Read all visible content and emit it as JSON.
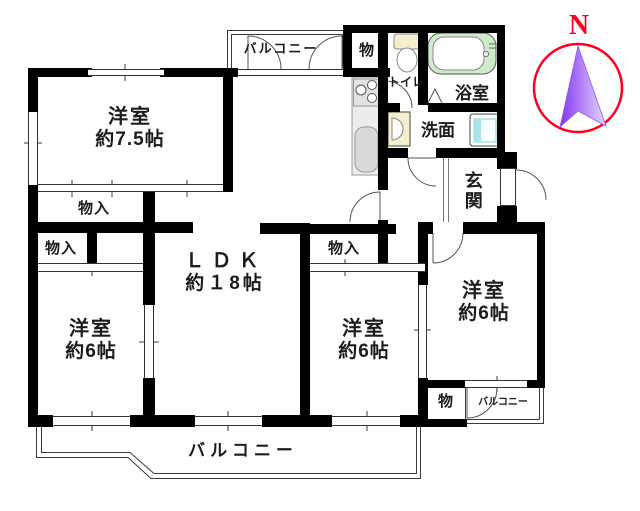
{
  "title": "apartment-floor-plan",
  "labels": {
    "room75": {
      "name": "洋室",
      "size": "約7.5帖"
    },
    "ldk": {
      "name": "ＬＤＫ",
      "size": "約１8帖"
    },
    "west6_left": {
      "name": "洋室",
      "size": "約6帖"
    },
    "west6_middle": {
      "name": "洋室",
      "size": "約6帖"
    },
    "west6_right": {
      "name": "洋室",
      "size": "約6帖"
    },
    "entrance": "玄関",
    "bathroom": "浴室",
    "washroom": "洗面",
    "toilet": "トイレ",
    "storage_top": "物",
    "storage_right": "物",
    "closet_1": "物入",
    "closet_2": "物入",
    "closet_middle": "物入",
    "balcony_main": "バルコニー",
    "balcony_top": "バルコニー",
    "balcony_right": "バルコニー",
    "compass_north": "N"
  },
  "colors": {
    "wall": "#000000",
    "line": "#3a3a3a",
    "bathtub_green": "#cfecca",
    "fixture_cream": "#f6efcd",
    "washer_cyan": "#a8e4ea",
    "compass_red": "#ff0021",
    "compass_arrow_purple": "#8435f2",
    "text": "#1c1c1c"
  }
}
